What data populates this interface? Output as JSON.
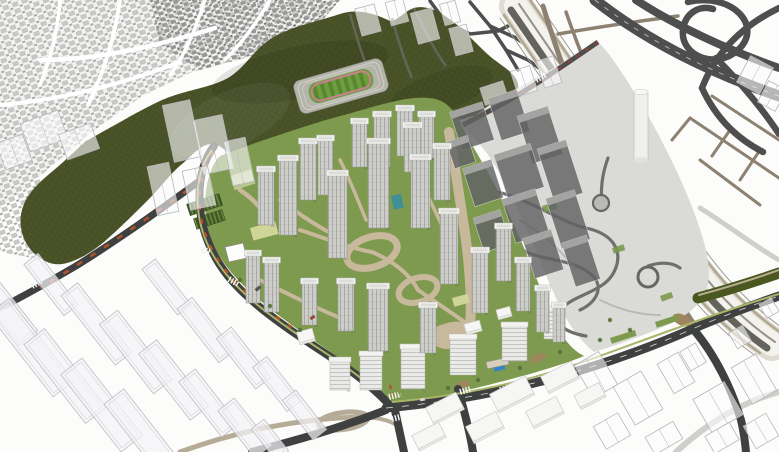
{
  "palette": {
    "background": "#fcfcfb",
    "village_base": "#f2f2f0",
    "village_block_light": "#c9c9c7",
    "village_block_mid": "#a9a9a7",
    "village_block_dark": "#8f8f8d",
    "village_street": "#ffffff",
    "hill": "#4b5429",
    "hill_mesh": "rgba(12,16,4,0.28)",
    "stadium_terrace": "#b4b4aa",
    "stadium_track": "#c8808f",
    "stadium_field": "#6ca03c",
    "road_dark": "#3f4040",
    "road_mid": "#4e4e4e",
    "road_light": "#cfcfcb",
    "road_tan": "#8d8171",
    "road_tan_light": "#b5ab97",
    "rail_base": "#dedbd2",
    "rail_white": "#f4f2ec",
    "rail_dark": "#55544d",
    "rail_beige": "#b1a68f",
    "site_green": "#7d9a4e",
    "verge": "#a9b569",
    "path_beige": "#c9b99c",
    "plaza": "#dadad6",
    "park_path_dark": "#6f6f6f",
    "park_path_light": "#b9b9b5",
    "tower_face": "#cdcdca",
    "tower_stripe": "#a9a9a6",
    "tower_roof": "#f3f3f1",
    "tower_side": "rgba(60,60,60,0.18)",
    "midrise_face": "#eaeae8",
    "midrise_line": "#c4c4c1",
    "massing_fill": "rgba(98,98,100,0.82)",
    "massing_top": "#a3a3a1",
    "ghost_fill": "rgba(244,244,247,0.72)",
    "ghost_stroke": "#bdbdc3",
    "wire_fill": "rgba(252,252,253,0.6)",
    "wire_stroke": "#b7b7bb",
    "flat_fill": "#f6f6f4",
    "flat_stroke": "#c9c9c6",
    "pool_teal": "#3e8f96",
    "pool_blue": "#2f86c8",
    "patch_yellow": "#cfd597",
    "patch_pale_green": "#c2cf9f",
    "patch_brown": "#a08460",
    "accent_orange": "#b1542e",
    "accent_red": "#a33d2e",
    "greenhouse_dark": "#3e5824",
    "greenhouse_light": "#6d8c3e",
    "green_bridge": "#4a5820",
    "green_bridge_path": "#b6ab8f",
    "tree_green": "#55703a",
    "crosswalk": "#f7f7f5",
    "cylinder": "#efefec"
  },
  "scene": {
    "towers": [
      [
        352,
        122,
        15,
        45
      ],
      [
        374,
        115,
        16,
        52
      ],
      [
        397,
        109,
        16,
        47
      ],
      [
        419,
        115,
        15,
        43
      ],
      [
        300,
        142,
        16,
        58
      ],
      [
        318,
        139,
        15,
        56
      ],
      [
        258,
        170,
        16,
        55
      ],
      [
        279,
        159,
        18,
        76
      ],
      [
        328,
        174,
        19,
        84
      ],
      [
        368,
        142,
        21,
        86
      ],
      [
        404,
        126,
        17,
        46
      ],
      [
        411,
        158,
        19,
        70
      ],
      [
        434,
        147,
        16,
        53
      ],
      [
        440,
        212,
        18,
        72
      ],
      [
        472,
        251,
        16,
        62
      ],
      [
        496,
        227,
        15,
        54
      ],
      [
        516,
        261,
        14,
        50
      ],
      [
        536,
        289,
        13,
        43
      ],
      [
        553,
        306,
        12,
        36
      ],
      [
        368,
        287,
        20,
        64
      ],
      [
        420,
        306,
        16,
        47
      ],
      [
        338,
        282,
        16,
        49
      ],
      [
        302,
        282,
        15,
        43
      ],
      [
        246,
        254,
        14,
        49
      ],
      [
        264,
        261,
        15,
        51
      ]
    ],
    "midrise": [
      [
        330,
        360,
        20,
        30
      ],
      [
        360,
        354,
        22,
        36
      ],
      [
        401,
        347,
        24,
        42
      ],
      [
        450,
        337,
        26,
        38
      ],
      [
        502,
        325,
        25,
        36
      ],
      [
        544,
        309,
        20,
        30
      ]
    ],
    "flats": [
      [
        428,
        399,
        34,
        19,
        -27
      ],
      [
        492,
        384,
        40,
        21,
        -27
      ],
      [
        543,
        368,
        34,
        19,
        -27
      ],
      [
        414,
        428,
        30,
        17,
        -27
      ],
      [
        468,
        418,
        34,
        19,
        -27
      ],
      [
        528,
        403,
        34,
        19,
        -27
      ],
      [
        576,
        388,
        28,
        16,
        -27
      ],
      [
        298,
        330,
        16,
        13,
        -15
      ],
      [
        372,
        336,
        15,
        11,
        -15
      ],
      [
        465,
        322,
        16,
        11,
        -15
      ],
      [
        497,
        308,
        14,
        10,
        -15
      ]
    ],
    "wires": [
      [
        582,
        356,
        28,
        38,
        -30
      ],
      [
        622,
        376,
        32,
        44,
        -30
      ],
      [
        664,
        356,
        24,
        34,
        -30
      ],
      [
        700,
        388,
        36,
        38,
        -30
      ],
      [
        740,
        358,
        28,
        42,
        -30
      ],
      [
        598,
        418,
        28,
        26,
        -30
      ],
      [
        648,
        428,
        32,
        20,
        -30
      ],
      [
        708,
        428,
        28,
        20,
        -30
      ],
      [
        748,
        418,
        26,
        26,
        -30
      ],
      [
        684,
        346,
        18,
        22,
        -30
      ],
      [
        732,
        328,
        16,
        18,
        -30
      ],
      [
        762,
        300,
        14,
        16,
        -30
      ],
      [
        742,
        60,
        26,
        30,
        28
      ],
      [
        762,
        84,
        20,
        24,
        28
      ],
      [
        358,
        6,
        20,
        28,
        -15
      ],
      [
        388,
        0,
        18,
        24,
        -15
      ],
      [
        414,
        10,
        22,
        32,
        -15
      ],
      [
        442,
        2,
        16,
        22,
        -15
      ],
      [
        452,
        26,
        18,
        28,
        -15
      ],
      [
        168,
        102,
        28,
        58,
        -12
      ],
      [
        198,
        117,
        30,
        55,
        -12
      ],
      [
        228,
        139,
        22,
        45,
        -12
      ],
      [
        152,
        164,
        22,
        50,
        -12
      ],
      [
        186,
        168,
        26,
        40,
        -12
      ],
      [
        24,
        116,
        40,
        30,
        -20
      ],
      [
        62,
        128,
        34,
        27,
        -20
      ],
      [
        0,
        138,
        28,
        28,
        -20
      ],
      [
        482,
        84,
        24,
        18,
        -18
      ],
      [
        514,
        68,
        20,
        26,
        -18
      ],
      [
        540,
        58,
        18,
        28,
        -18
      ]
    ],
    "ghosts": [
      [
        -10,
        262,
        24,
        85,
        -38
      ],
      [
        18,
        295,
        26,
        105,
        -38
      ],
      [
        52,
        326,
        26,
        100,
        -38
      ],
      [
        88,
        356,
        27,
        98,
        -38
      ],
      [
        126,
        388,
        25,
        80,
        -38
      ],
      [
        42,
        252,
        18,
        65,
        -38
      ],
      [
        86,
        280,
        21,
        88,
        -38
      ],
      [
        124,
        308,
        23,
        88,
        -38
      ],
      [
        162,
        338,
        23,
        84,
        -38
      ],
      [
        198,
        368,
        21,
        70,
        -38
      ],
      [
        234,
        398,
        21,
        60,
        -38
      ],
      [
        158,
        258,
        17,
        58,
        -38
      ],
      [
        196,
        296,
        19,
        68,
        -38
      ],
      [
        234,
        326,
        19,
        64,
        -38
      ],
      [
        268,
        356,
        18,
        56,
        -38
      ],
      [
        296,
        390,
        17,
        50,
        -38
      ],
      [
        262,
        420,
        16,
        40,
        -38
      ]
    ],
    "massing": [
      [
        455,
        106,
        34,
        40,
        -18
      ],
      [
        494,
        93,
        30,
        44,
        -18
      ],
      [
        524,
        110,
        32,
        50,
        -18
      ],
      [
        500,
        148,
        38,
        46,
        -18
      ],
      [
        545,
        143,
        30,
        56,
        -18
      ],
      [
        468,
        163,
        30,
        40,
        -18
      ],
      [
        508,
        193,
        35,
        46,
        -18
      ],
      [
        553,
        193,
        30,
        52,
        -18
      ],
      [
        478,
        213,
        28,
        36,
        -18
      ],
      [
        528,
        233,
        30,
        42,
        -18
      ],
      [
        568,
        238,
        26,
        46,
        -18
      ],
      [
        450,
        138,
        22,
        28,
        -18
      ]
    ],
    "trees": [
      [
        448,
        388
      ],
      [
        478,
        380
      ],
      [
        520,
        368
      ],
      [
        560,
        352
      ],
      [
        600,
        340
      ],
      [
        630,
        330
      ],
      [
        300,
        330
      ],
      [
        270,
        306
      ],
      [
        240,
        280
      ],
      [
        610,
        320
      ]
    ],
    "cars": [
      [
        310,
        316,
        5,
        3,
        -35,
        "#a04a30"
      ],
      [
        255,
        287,
        6,
        3,
        -40,
        "#555555"
      ],
      [
        202,
        249,
        5,
        3,
        -50,
        "#ffffff"
      ],
      [
        420,
        398,
        5,
        3,
        -10,
        "#dddddd"
      ]
    ]
  }
}
